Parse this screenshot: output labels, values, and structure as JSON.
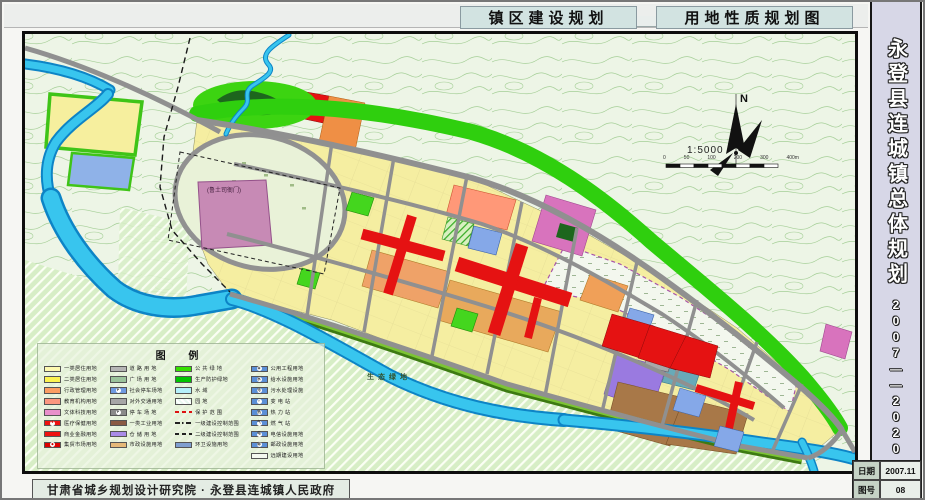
{
  "header": {
    "title_left": "镇区建设规划",
    "title_right": "用地性质规划图"
  },
  "sidebar": {
    "title": "永登县连城镇总体规划",
    "years": "2007——2020",
    "doc_table": {
      "date_label": "日期",
      "date_value": "2007.11",
      "sheet_label": "图号",
      "sheet_value": "08"
    }
  },
  "footer": {
    "attribution": "甘肃省城乡规划设计研究院 · 永登县连城镇人民政府"
  },
  "map": {
    "north_label": "N",
    "scale_text": "1:5000",
    "scalebar_ticks": [
      "0",
      "50",
      "100",
      "200",
      "300",
      "400m"
    ],
    "labels": {
      "eco_green": "生态绿地",
      "heritage": "(鲁土司衙门)"
    },
    "colors": {
      "residential_yellow": "#f5eea1",
      "commercial_red": "#e51212",
      "industry_brown": "#a87848",
      "warehouse_purple": "#9a7ae0",
      "green_space": "#2fcf0e",
      "water_cyan": "#38c5ee",
      "road_gray": "#909090",
      "heritage_purple": "#c78ab5"
    }
  },
  "legend": {
    "title": "图  例",
    "columns": [
      [
        {
          "type": "fill",
          "color": "#fdf9b0",
          "label": "一类居住用地"
        },
        {
          "type": "fill",
          "color": "#fcf351",
          "label": "二类居住用地"
        },
        {
          "type": "fill",
          "color": "#fb9d63",
          "label": "行政管理用地"
        },
        {
          "type": "fill",
          "color": "#fc9780",
          "label": "教育机构用地"
        },
        {
          "type": "fill",
          "color": "#e88fcb",
          "label": "文体科技用地"
        },
        {
          "type": "icon-red",
          "color": "#ee1111",
          "icon": "✚",
          "label": "医疗保健用地"
        },
        {
          "type": "fill",
          "color": "#ee1111",
          "label": "商业金融用地"
        },
        {
          "type": "icon-red",
          "color": "#dd0000",
          "icon": "◆",
          "label": "集贸市场用地"
        }
      ],
      [
        {
          "type": "fill",
          "color": "#b5b5b5",
          "label": "道 路 用 地"
        },
        {
          "type": "fill",
          "color": "#9cc49c",
          "label": "广 场 用 地"
        },
        {
          "type": "icon-blue",
          "color": "#6f9ae0",
          "icon": "P",
          "label": "社会停车场地"
        },
        {
          "type": "fill",
          "color": "#a6a6a6",
          "label": "对外交通用地"
        },
        {
          "type": "icon-dark",
          "color": "#8a8a8a",
          "icon": "P",
          "label": "停 车 场 地"
        },
        {
          "type": "fill",
          "color": "#8a5a44",
          "label": "一类工业用地"
        },
        {
          "type": "fill",
          "color": "#a98be8",
          "label": "仓 储 用 地"
        },
        {
          "type": "fill",
          "color": "#e5b878",
          "label": "市政设施用地"
        }
      ],
      [
        {
          "type": "fill",
          "color": "#35e000",
          "label": "公 共 绿 地"
        },
        {
          "type": "fill",
          "color": "#00c400",
          "label": "生产防护绿地"
        },
        {
          "type": "fill",
          "color": "#b5f0fb",
          "label": "水  域"
        },
        {
          "type": "hatch",
          "label": "园  地"
        },
        {
          "type": "line-red",
          "label": "保 护 范 围"
        },
        {
          "type": "line-dashdot",
          "label": "一级建设控制范围"
        },
        {
          "type": "line-dash",
          "label": "二级建设控制范围"
        },
        {
          "type": "fill",
          "color": "#7f9fd0",
          "label": "环卫设施用地"
        }
      ],
      [
        {
          "type": "icon-blue",
          "color": "#5b8fd6",
          "icon": "◉",
          "label": "公用工程用地"
        },
        {
          "type": "icon-blue",
          "color": "#5b8fd6",
          "icon": "水",
          "label": "给水设施用地"
        },
        {
          "type": "icon-blue",
          "color": "#5b8fd6",
          "icon": "污",
          "label": "污水处理设施"
        },
        {
          "type": "icon-blue",
          "color": "#5b8fd6",
          "icon": "⚡",
          "label": "变 电 站"
        },
        {
          "type": "icon-blue",
          "color": "#5b8fd6",
          "icon": "热",
          "label": "热 力 站"
        },
        {
          "type": "icon-blue",
          "color": "#5b8fd6",
          "icon": "气",
          "label": "燃 气 站"
        },
        {
          "type": "icon-blue",
          "color": "#5b8fd6",
          "icon": "电",
          "label": "电信设施用地"
        },
        {
          "type": "icon-blue",
          "color": "#5b8fd6",
          "icon": "邮",
          "label": "邮政设施用地"
        },
        {
          "type": "white",
          "label": "远期建设用地"
        }
      ]
    ]
  }
}
